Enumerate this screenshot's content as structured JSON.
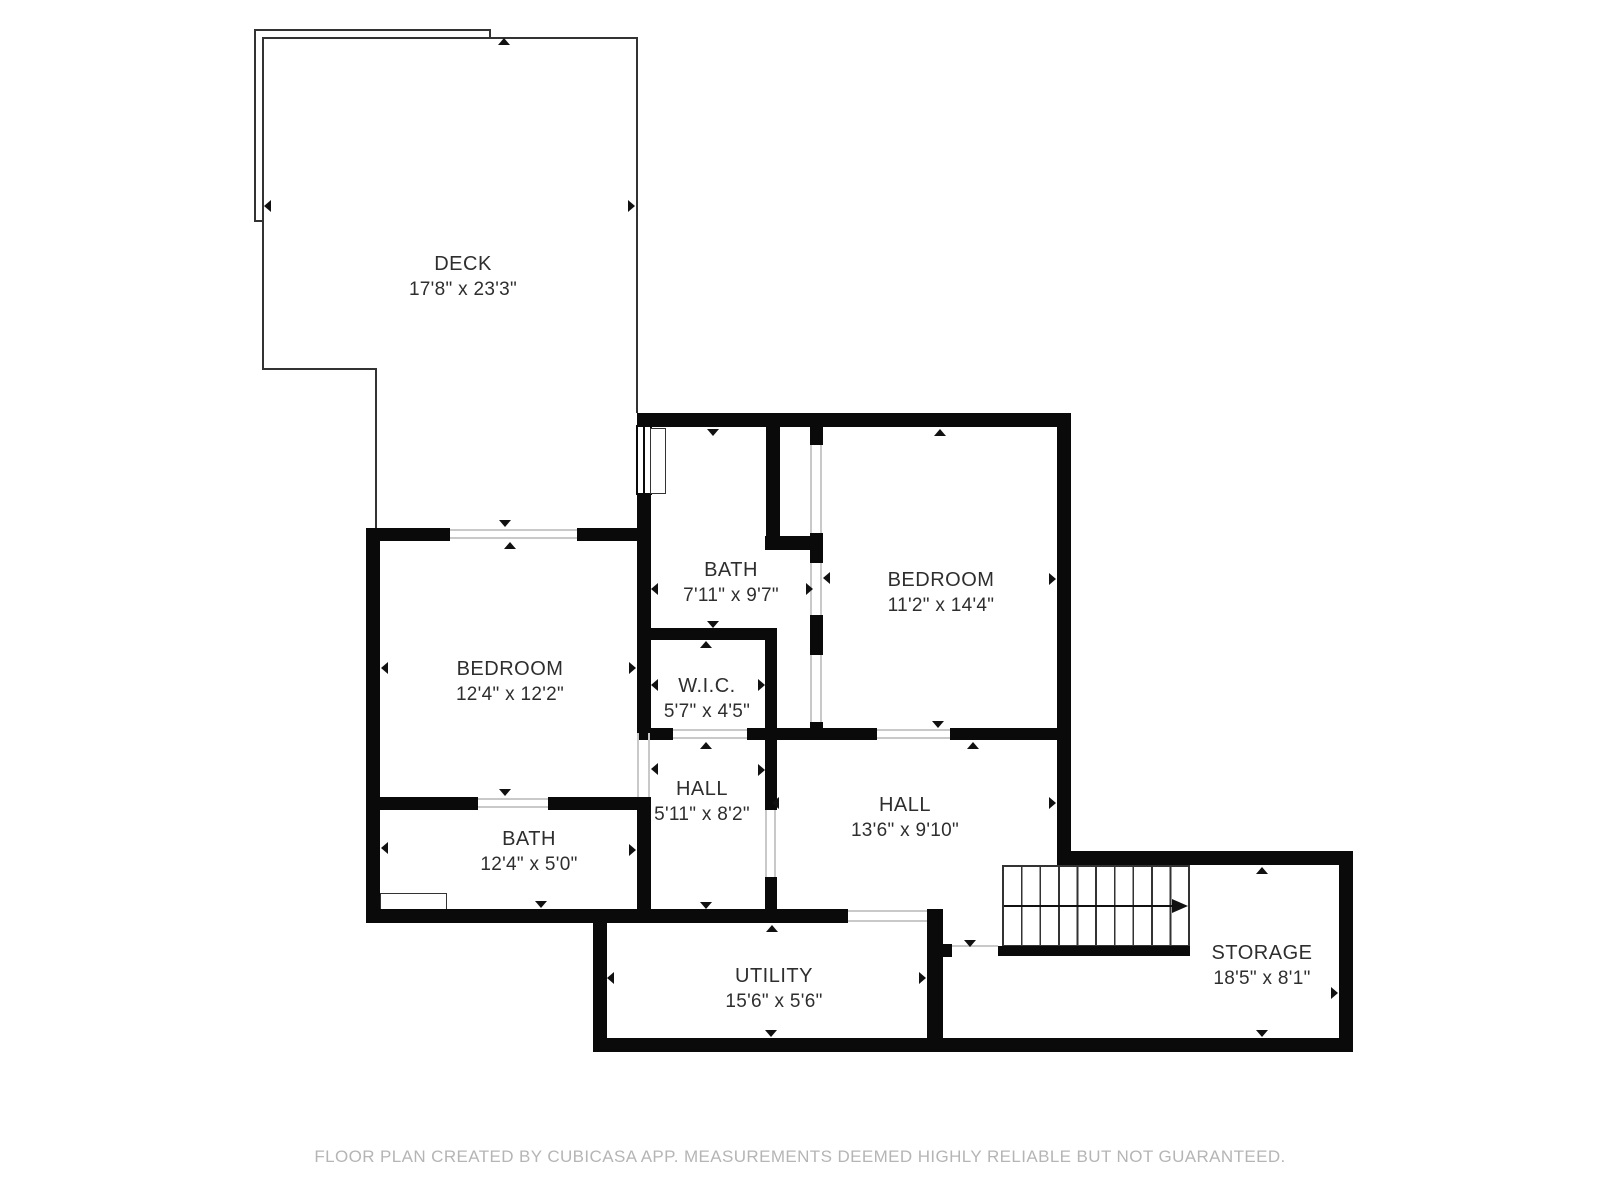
{
  "rooms": {
    "deck": {
      "name": "DECK",
      "dims": "17'8\" x 23'3\""
    },
    "bath_top": {
      "name": "BATH",
      "dims": "7'11\" x 9'7\""
    },
    "bedroom_right": {
      "name": "BEDROOM",
      "dims": "11'2\" x 14'4\""
    },
    "bedroom_left": {
      "name": "BEDROOM",
      "dims": "12'4\" x 12'2\""
    },
    "wic": {
      "name": "W.I.C.",
      "dims": "5'7\" x 4'5\""
    },
    "hall_left": {
      "name": "HALL",
      "dims": "5'11\" x 8'2\""
    },
    "hall_right": {
      "name": "HALL",
      "dims": "13'6\" x 9'10\""
    },
    "bath_bottom": {
      "name": "BATH",
      "dims": "12'4\" x 5'0\""
    },
    "utility": {
      "name": "UTILITY",
      "dims": "15'6\" x 5'6\""
    },
    "storage": {
      "name": "STORAGE",
      "dims": "18'5\" x 8'1\""
    }
  },
  "footer": {
    "text": "FLOOR PLAN CREATED BY CUBICASA APP. MEASUREMENTS DEEMED HIGHLY RELIABLE BUT NOT GUARANTEED."
  },
  "colors": {
    "wall": "#0a0a0a",
    "thin_line": "#333333",
    "threshold_line": "#c9c9c9",
    "label_text": "#2e2e2e",
    "footer_text": "#b5b5b5",
    "background": "#ffffff"
  }
}
